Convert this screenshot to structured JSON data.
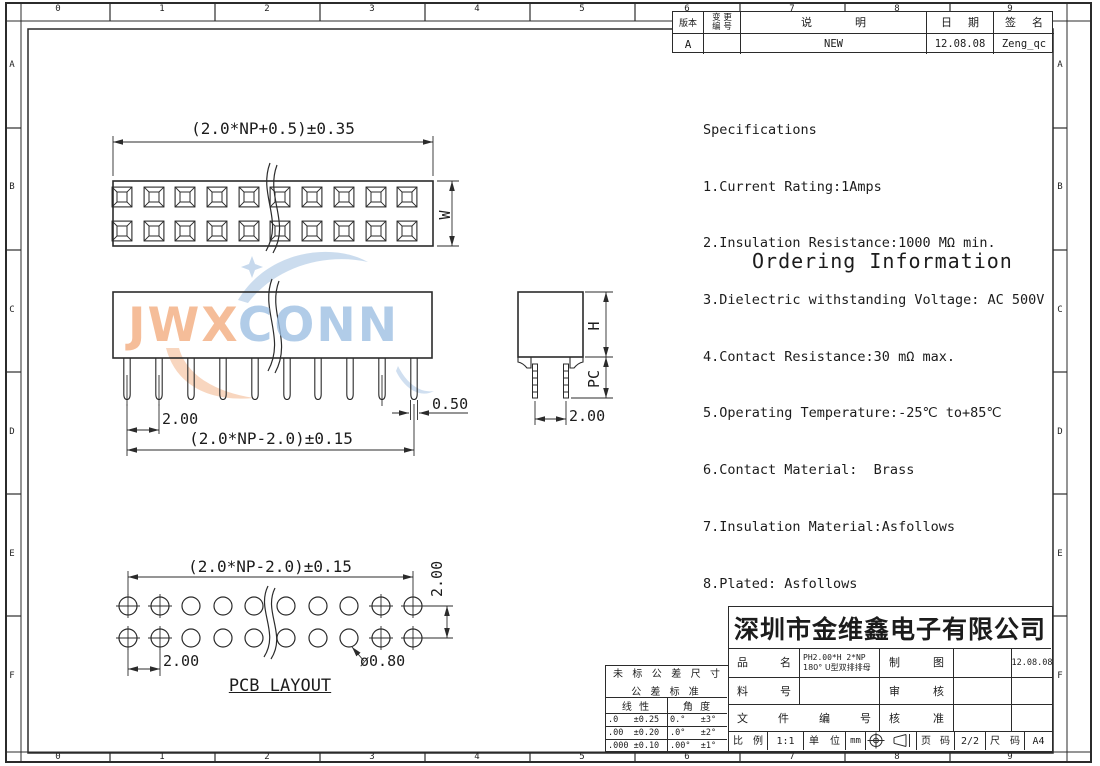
{
  "ruler": {
    "top": [
      "0",
      "1",
      "2",
      "3",
      "4",
      "5",
      "6",
      "7",
      "8",
      "9"
    ],
    "bottom": [
      "0",
      "1",
      "2",
      "3",
      "4",
      "5",
      "6",
      "7",
      "8",
      "9"
    ],
    "left": [
      "A",
      "B",
      "C",
      "D",
      "E",
      "F"
    ],
    "right": [
      "A",
      "B",
      "C",
      "D",
      "E",
      "F"
    ]
  },
  "revision_table": {
    "col_rev": "版本",
    "col_change_line1": "变 更",
    "col_change_line2": "编 号",
    "col_desc": "说 明",
    "col_date": "日 期",
    "col_sign": "签 名",
    "row_rev": "A",
    "row_change": "",
    "row_desc": "NEW",
    "row_date": "12.08.08",
    "row_sign": "Zeng_qc"
  },
  "specifications": {
    "title": "Specifications",
    "items": [
      "1.Current Rating:1Amps",
      "2.Insulation Resistance:1000 MΩ min.",
      "3.Dielectric withstanding Voltage: AC 500V",
      "4.Contact Resistance:30 mΩ max.",
      "5.Operating Temperature:-25℃ to+85℃",
      "6.Contact Material:  Brass",
      "7.Insulation Material:Asfollows",
      "8.Plated: Asfollows"
    ]
  },
  "ordering_title": "Ordering Information",
  "watermark": {
    "part1": "JWX",
    "part2": "CONN"
  },
  "drawings": {
    "top_view": {
      "dim_width": "(2.0*NP+0.5)±0.35",
      "dim_height": "W"
    },
    "front_view": {
      "dim_pitch": "2.00",
      "dim_span": "(2.0*NP-2.0)±0.15",
      "dim_pin": "0.50"
    },
    "side_view": {
      "dim_height": "H",
      "dim_tail": "PC",
      "dim_pitch": "2.00"
    },
    "pcb_layout": {
      "title": "PCB LAYOUT",
      "dim_span": "(2.0*NP-2.0)±0.15",
      "dim_row": "2.00",
      "dim_pitch": "2.00",
      "dim_hole": "ø0.80"
    }
  },
  "company": "深圳市金维鑫电子有限公司",
  "title_block": {
    "part_name_label": "品 名",
    "part_name_line1": "PH2.00*H 2*NP",
    "part_name_line2": "180° U型双排排母",
    "part_no_label": "料 号",
    "doc_no_label": "文 件 编 号",
    "draw_label": "制 图",
    "draw_date": "12.08.08",
    "check_label": "审 核",
    "approve_label": "核 准",
    "scale_label": "比 例",
    "scale_value": "1:1",
    "unit_label": "单 位",
    "unit_value": "mm",
    "page_label": "页 码",
    "page_value": "2/2",
    "size_label": "尺 码",
    "size_value": "A4"
  },
  "tolerance_table": {
    "title_line1": "未 标 公 差 尺 寸",
    "title_line2": "公 差 标 准",
    "col_linear": "线 性",
    "col_angle": "角 度",
    "rows": [
      [
        ".0   ±0.25",
        "0.°   ±3°"
      ],
      [
        ".00  ±0.20",
        ".0°   ±2°"
      ],
      [
        ".000 ±0.10",
        ".00°  ±1°"
      ]
    ]
  }
}
